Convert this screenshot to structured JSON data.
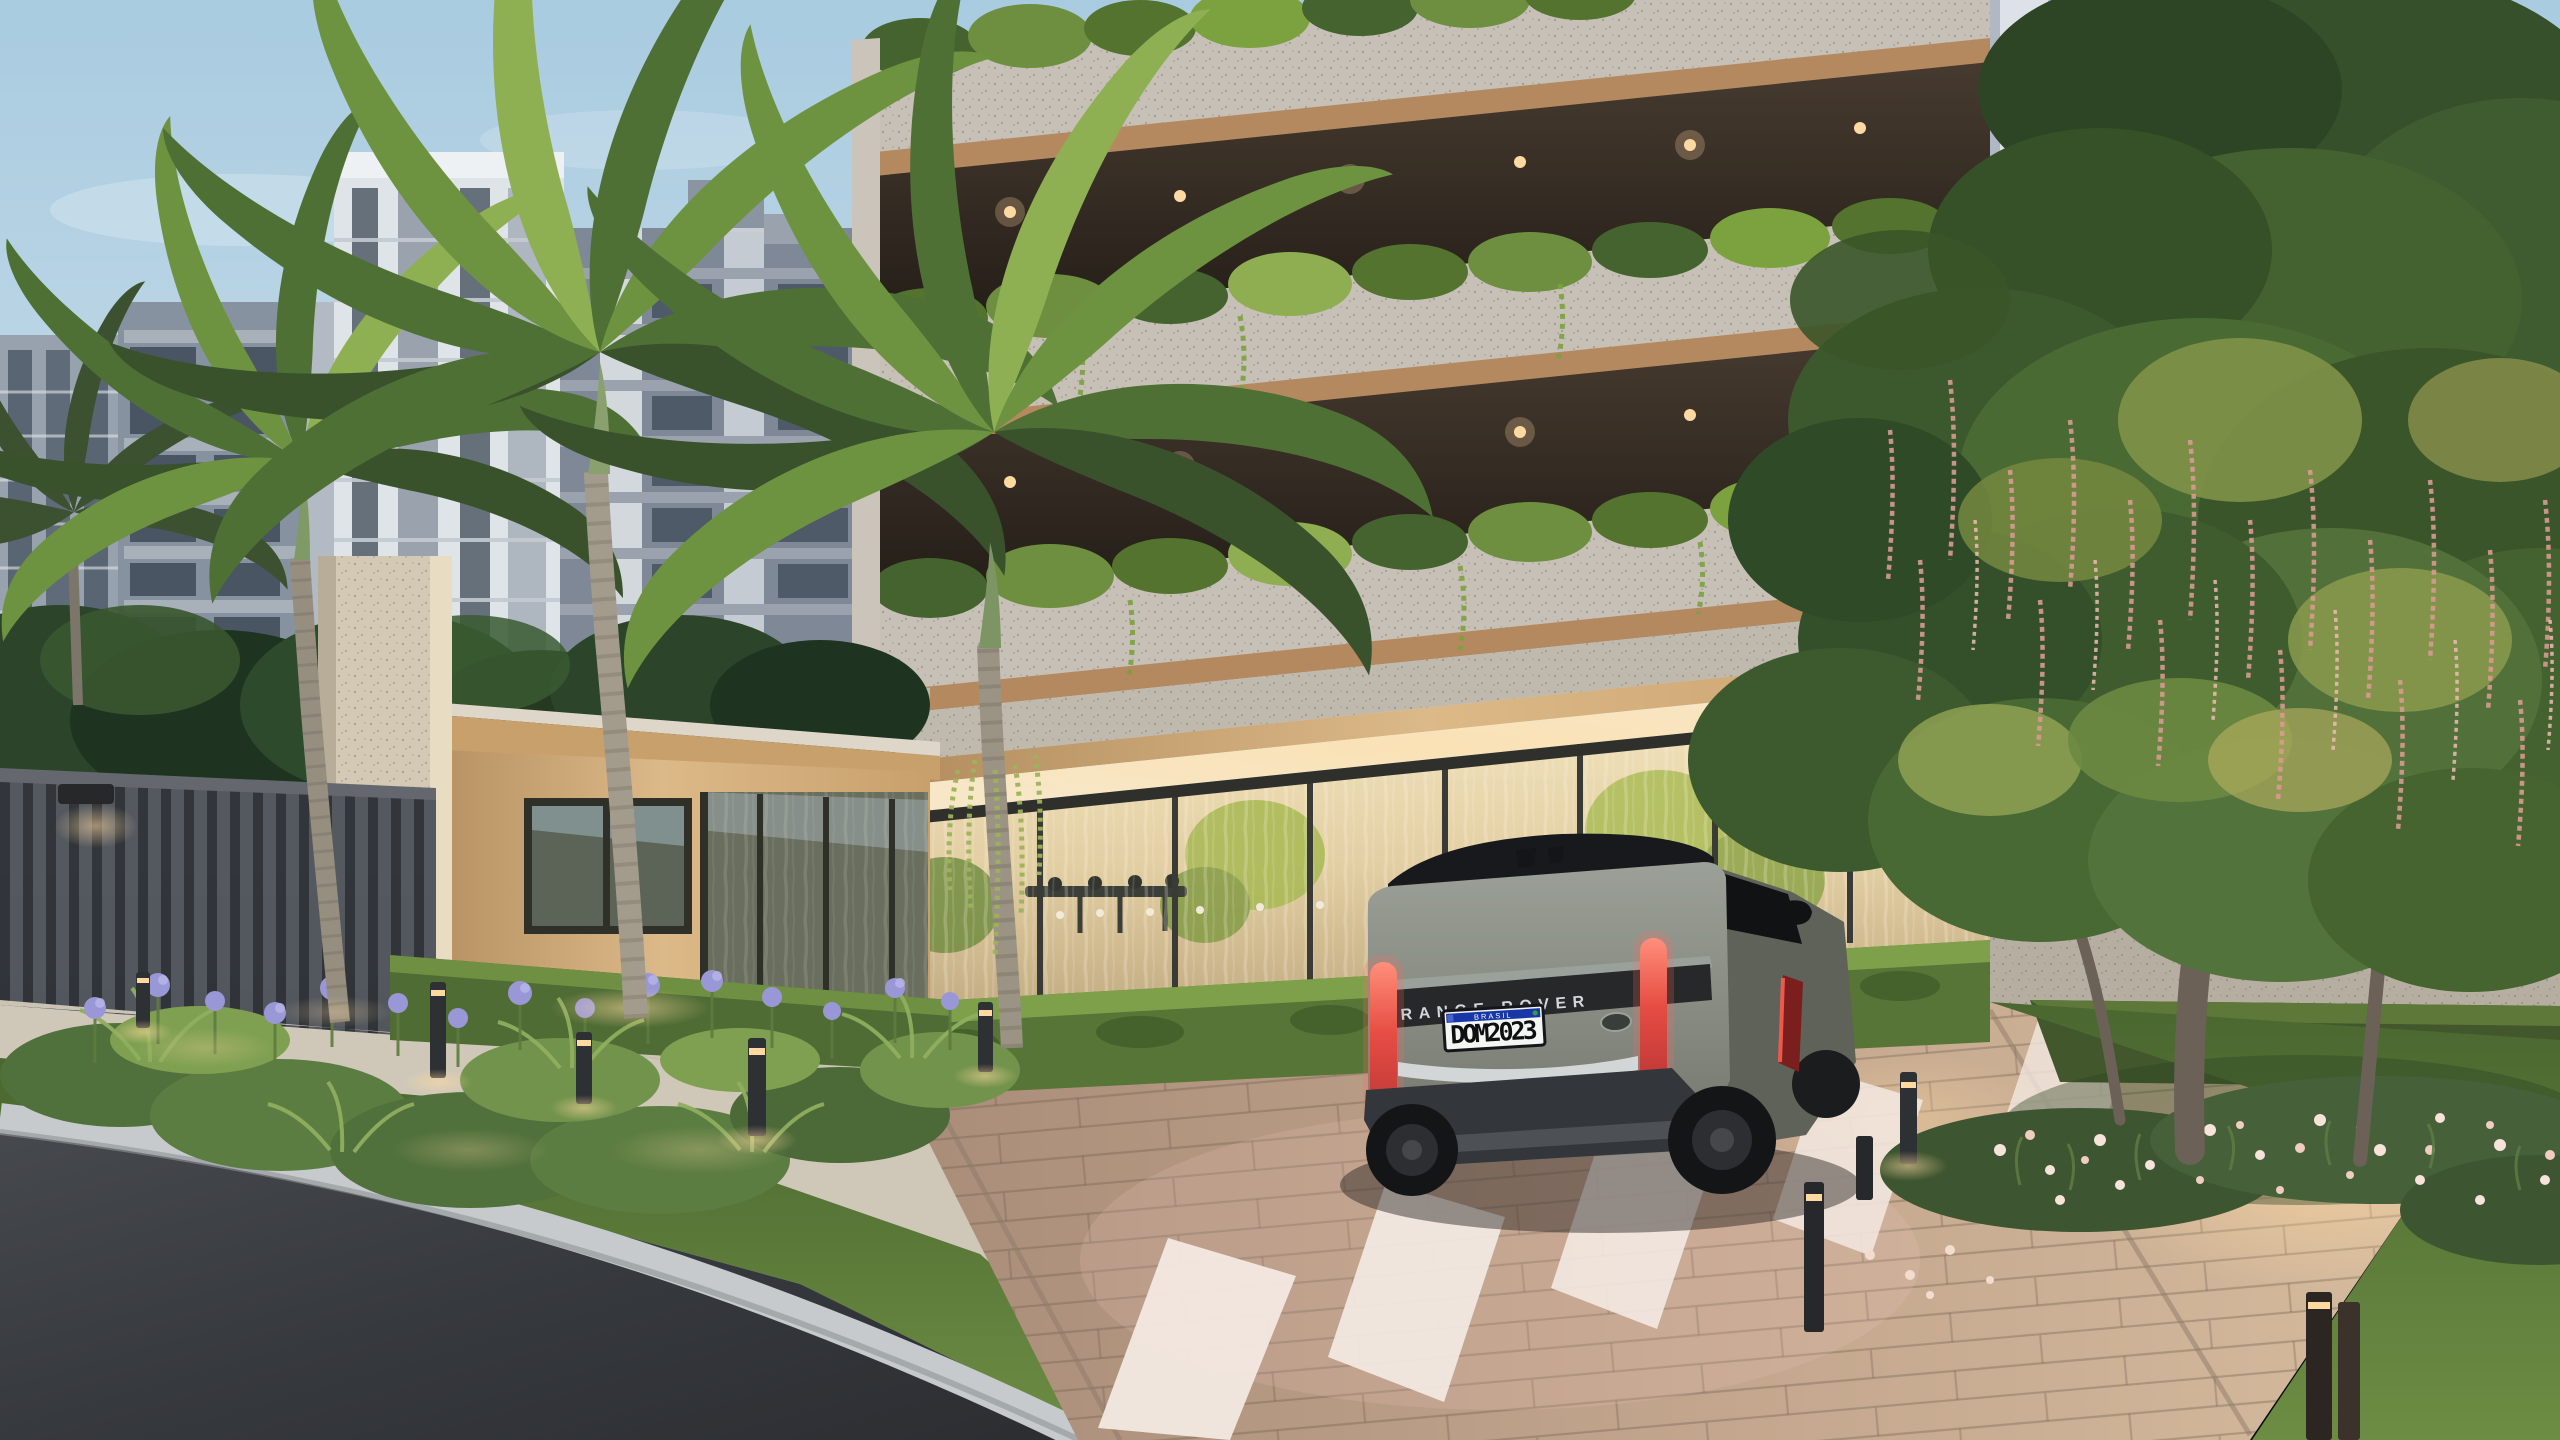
{
  "scene": {
    "type": "architectural-render",
    "time_of_day": "dusk",
    "subject": "luxury residential tower entrance with landscaped driveway",
    "elements": [
      "apartment tower with granite balcony slabs and planted balconies",
      "warm recessed balcony downlights",
      "glass entrance lobby with sheer curtains and long table",
      "timber gatehouse pavilion with travertine column",
      "dark slatted perimeter fence with wall light",
      "royal palm trees",
      "large flowering tree with pink hanging racemes",
      "grey Range Rover SUV on paver driveway",
      "white zebra crosswalk",
      "asphalt street with granite curb and concrete sidewalk",
      "garden beds with purple agapanthus and white-pink lilies",
      "black bollard path lights",
      "background mid-rise apartment buildings under pale blue sky"
    ]
  },
  "vehicle": {
    "badge": "RANGE ROVER",
    "license_plate": "DOM2023",
    "plate_country_band": "BRASIL"
  },
  "colors": {
    "sky_top": "#a9cbe0",
    "sky_horizon": "#e6edf2",
    "granite": "#c0bab0",
    "wood": "#c8a06c",
    "lobby_glow": "#ecd9b2",
    "hedge_green": "#567536",
    "palm_green": "#4f7034",
    "canopy_green": "#3f5c31",
    "agapanthus_purple": "#9a97d6",
    "blossom_pink": "#e7b9ac",
    "raceme_pink": "#d89a92",
    "asphalt": "#36393e",
    "curb": "#c6cacc",
    "sidewalk": "#cbc4b4",
    "pavers": "#bb9e89",
    "crosswalk_stripe": "#f3e9e2",
    "car_body": "#84887e",
    "car_roof": "#17191c",
    "tail_light_red": "#e0463c",
    "plate_bg": "#f4f6f3",
    "plate_band_blue": "#1736a8",
    "warm_light": "#ffd9a0"
  }
}
